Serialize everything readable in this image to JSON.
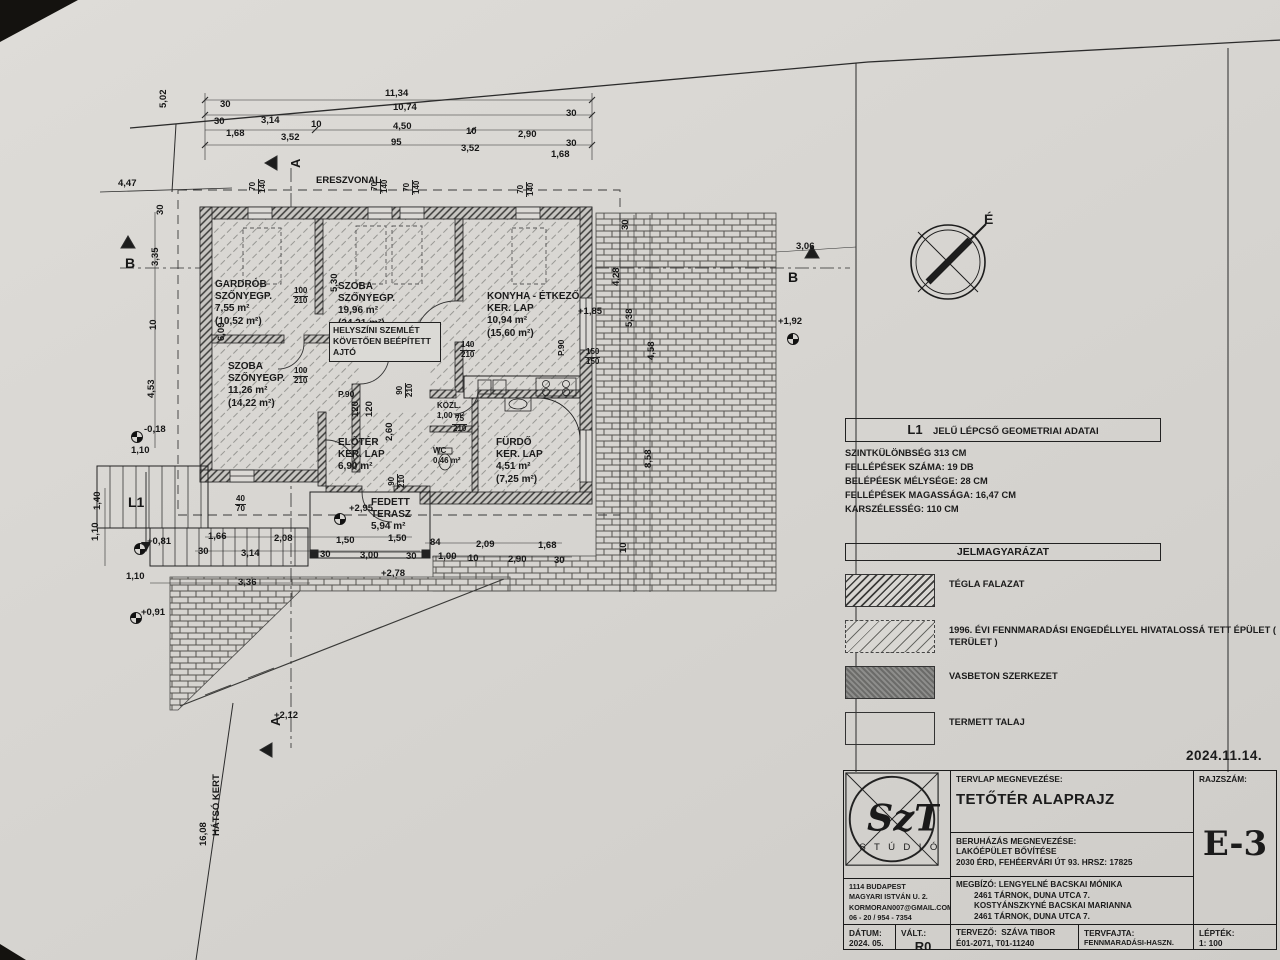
{
  "sheet": {
    "date": "2024.11.14."
  },
  "plan": {
    "north_label": "É",
    "note_box": "HELYSZÍNI SZEMLÉT\nKÖVETŐEN BEÉPÍTETT\nAJTÓ",
    "rooms": [
      {
        "text": "GARDRÓB\nSZŐNYEGP.\n7,55 m²\n(10,52 m²)",
        "x": 215,
        "y": 279
      },
      {
        "text": "SZOBA\nSZŐNYEGP.\n19,96 m²\n(24,21 m²)",
        "x": 338,
        "y": 281
      },
      {
        "text": "KONYHA - ÉTKEZŐ\nKER. LAP\n10,94 m²\n(15,60 m²)",
        "x": 487,
        "y": 291
      },
      {
        "text": "SZOBA\nSZŐNYEGP.\n11,26 m²\n(14,22 m²)",
        "x": 228,
        "y": 361
      },
      {
        "text": "ELŐTÉR\nKER. LAP\n6,90 m²",
        "x": 338,
        "y": 437
      },
      {
        "text": "KÖZL.\n1,00 m²",
        "x": 437,
        "y": 401,
        "fs": 8
      },
      {
        "text": "WC\n0,46 m²",
        "x": 433,
        "y": 446,
        "fs": 8
      },
      {
        "text": "FÜRDŐ\nKER. LAP\n4,51 m²\n(7,25 m²)",
        "x": 496,
        "y": 437
      },
      {
        "text": "FEDETT\nTERASZ\n5,94 m²",
        "x": 371,
        "y": 497
      }
    ],
    "dims": [
      {
        "t": "11,34",
        "x": 385,
        "y": 88
      },
      {
        "t": "30",
        "x": 220,
        "y": 99
      },
      {
        "t": "10,74",
        "x": 393,
        "y": 102
      },
      {
        "t": "30",
        "x": 566,
        "y": 108
      },
      {
        "t": "30",
        "x": 214,
        "y": 116
      },
      {
        "t": "3,14",
        "x": 261,
        "y": 115
      },
      {
        "t": "10",
        "x": 311,
        "y": 119
      },
      {
        "t": "4,50",
        "x": 393,
        "y": 121
      },
      {
        "t": "10",
        "x": 466,
        "y": 126
      },
      {
        "t": "2,90",
        "x": 518,
        "y": 129
      },
      {
        "t": "30",
        "x": 566,
        "y": 138
      },
      {
        "t": "1,68",
        "x": 226,
        "y": 128
      },
      {
        "t": "3,52",
        "x": 281,
        "y": 132
      },
      {
        "t": "95",
        "x": 391,
        "y": 137
      },
      {
        "t": "3,52",
        "x": 461,
        "y": 143
      },
      {
        "t": "1,68",
        "x": 551,
        "y": 149
      },
      {
        "t": "5,02",
        "x": 158,
        "y": 108,
        "r": -90
      },
      {
        "t": "4,47",
        "x": 118,
        "y": 178
      },
      {
        "t": "30",
        "x": 155,
        "y": 215,
        "r": -90
      },
      {
        "t": "3,35",
        "x": 150,
        "y": 266,
        "r": -90
      },
      {
        "t": "10",
        "x": 148,
        "y": 330,
        "r": -90
      },
      {
        "t": "4,53",
        "x": 146,
        "y": 398,
        "r": -90
      },
      {
        "t": "6,09",
        "x": 216,
        "y": 341,
        "r": -90
      },
      {
        "t": "5,30",
        "x": 329,
        "y": 292,
        "r": -90
      },
      {
        "t": "2,60",
        "x": 384,
        "y": 441,
        "r": -90
      },
      {
        "t": "120",
        "x": 350,
        "y": 417,
        "r": -90
      },
      {
        "t": "120",
        "x": 364,
        "y": 417,
        "r": -90
      },
      {
        "t": "1,10",
        "x": 131,
        "y": 445
      },
      {
        "t": "1,40",
        "x": 92,
        "y": 510,
        "r": -90
      },
      {
        "t": "1,10",
        "x": 90,
        "y": 541,
        "r": -90
      },
      {
        "t": "1,10",
        "x": 126,
        "y": 571
      },
      {
        "t": "3,36",
        "x": 238,
        "y": 577
      },
      {
        "t": "16,08",
        "x": 198,
        "y": 846,
        "r": -90
      },
      {
        "t": "3,06",
        "x": 796,
        "y": 241
      },
      {
        "t": "30",
        "x": 620,
        "y": 230,
        "r": -90
      },
      {
        "t": "4,28",
        "x": 611,
        "y": 286,
        "r": -90
      },
      {
        "t": "5,38",
        "x": 624,
        "y": 327,
        "r": -90
      },
      {
        "t": "4,58",
        "x": 646,
        "y": 360,
        "r": -90
      },
      {
        "t": "8,58",
        "x": 643,
        "y": 468,
        "r": -90
      },
      {
        "t": "10",
        "x": 618,
        "y": 553,
        "r": -90
      },
      {
        "t": "1,66",
        "x": 208,
        "y": 531
      },
      {
        "t": "2,08",
        "x": 274,
        "y": 533
      },
      {
        "t": "1,50",
        "x": 336,
        "y": 535
      },
      {
        "t": "1,50",
        "x": 388,
        "y": 533
      },
      {
        "t": "30",
        "x": 198,
        "y": 546
      },
      {
        "t": "3,14",
        "x": 241,
        "y": 548
      },
      {
        "t": "30",
        "x": 320,
        "y": 549
      },
      {
        "t": "3,00",
        "x": 360,
        "y": 550
      },
      {
        "t": "30",
        "x": 406,
        "y": 551
      },
      {
        "t": "84",
        "x": 430,
        "y": 537
      },
      {
        "t": "2,09",
        "x": 476,
        "y": 539
      },
      {
        "t": "1,68",
        "x": 538,
        "y": 540
      },
      {
        "t": "1,00",
        "x": 438,
        "y": 551
      },
      {
        "t": "10",
        "x": 468,
        "y": 553
      },
      {
        "t": "2,90",
        "x": 508,
        "y": 554
      },
      {
        "t": "30",
        "x": 554,
        "y": 555
      }
    ],
    "levels": [
      {
        "t": "-0,18",
        "x": 144,
        "y": 424
      },
      {
        "t": "+0,81",
        "x": 147,
        "y": 536
      },
      {
        "t": "+0,91",
        "x": 141,
        "y": 607
      },
      {
        "t": "+2,95",
        "x": 349,
        "y": 503
      },
      {
        "t": "+2,78",
        "x": 381,
        "y": 568
      },
      {
        "t": "+2,12",
        "x": 274,
        "y": 710
      },
      {
        "t": "+1,85",
        "x": 578,
        "y": 306
      },
      {
        "t": "+1,92",
        "x": 778,
        "y": 316
      }
    ],
    "openings": [
      {
        "top": "100",
        "bot": "210",
        "x": 293,
        "y": 287
      },
      {
        "top": "100",
        "bot": "210",
        "x": 293,
        "y": 367
      },
      {
        "top": "140",
        "bot": "210",
        "x": 460,
        "y": 341
      },
      {
        "top": "75",
        "bot": "210",
        "x": 452,
        "y": 415
      },
      {
        "top": "90",
        "bot": "210",
        "x": 396,
        "y": 398,
        "r": -90
      },
      {
        "top": "90",
        "bot": "210",
        "x": 388,
        "y": 489,
        "r": -90
      },
      {
        "top": "150",
        "bot": "150",
        "x": 585,
        "y": 348
      },
      {
        "top": "40",
        "bot": "70",
        "x": 235,
        "y": 495
      },
      {
        "top": "70",
        "bot": "140",
        "x": 249,
        "y": 194,
        "r": -90
      },
      {
        "top": "70",
        "bot": "140",
        "x": 371,
        "y": 194,
        "r": -90
      },
      {
        "top": "70",
        "bot": "140",
        "x": 403,
        "y": 195,
        "r": -90
      },
      {
        "top": "70",
        "bot": "140",
        "x": 517,
        "y": 197,
        "r": -90
      }
    ],
    "misc": [
      {
        "t": "ERESZVONAL",
        "x": 316,
        "y": 175,
        "fs": 9.5
      },
      {
        "t": "HÁTSÓ KERT",
        "x": 211,
        "y": 836,
        "r": -90,
        "fs": 9.5
      },
      {
        "t": "L1",
        "x": 128,
        "y": 494,
        "fs": 14
      },
      {
        "t": "P.90",
        "x": 338,
        "y": 389,
        "fs": 8.5
      },
      {
        "t": "P.90",
        "x": 556,
        "y": 356,
        "r": -90,
        "fs": 8.5
      },
      {
        "t": "B",
        "x": 125,
        "y": 255,
        "fs": 14
      },
      {
        "t": "B",
        "x": 788,
        "y": 269,
        "fs": 14
      },
      {
        "t": "A",
        "x": 288,
        "y": 168,
        "r": -90,
        "fs": 13
      },
      {
        "t": "A",
        "x": 268,
        "y": 726,
        "r": -90,
        "fs": 13
      }
    ]
  },
  "stair_table": {
    "code": "L1",
    "title": "JELŰ LÉPCSŐ GEOMETRIAI ADATAI",
    "rows": [
      "SZINTKÜLÖNBSÉG 313 CM",
      "FELLÉPÉSEK SZÁMA: 19 DB",
      "BELÉPÉESK MÉLYSÉGE: 28 CM",
      "FELLÉPÉSEK MAGASSÁGA: 16,47 CM",
      "KARSZÉLESSÉG: 110 CM"
    ]
  },
  "legend": {
    "title": "JELMAGYARÁZAT",
    "items": [
      {
        "label": "TÉGLA FALAZAT",
        "pattern": "brick-wall-hatch"
      },
      {
        "label": "1996. ÉVI FENNMARADÁSI ENGEDÉLLYEL HIVATALOSSÁ TETT ÉPÜLET ( TERÜLET )",
        "pattern": "dashed-hatch"
      },
      {
        "label": "VASBETON SZERKEZET",
        "pattern": "concrete-hatch"
      },
      {
        "label": "TERMETT TALAJ",
        "pattern": "soil-hatch"
      }
    ]
  },
  "title_block": {
    "logo": {
      "main": "SzT",
      "sub": "S T Ú D I Ó"
    },
    "sheet_name_label": "TERVLAP MEGNEVEZÉSE:",
    "sheet_name": "TETŐTÉR ALAPRAJZ",
    "project_label": "BERUHÁZÁS MEGNEVEZÉSE:",
    "project_name": "LAKÓÉPÜLET BŐVÍTÉSE",
    "project_address": "2030 ÉRD, FEHÉERVÁRI ÚT 93.  HRSZ: 17825",
    "client": "MEGBÍZÓ: LENGYELNÉ BACSKAI MÓNIKA\n        2461 TÁRNOK, DUNA UTCA 7.\n        KOSTYÁNSZKYNÉ BACSKAI MARIANNA\n        2461 TÁRNOK, DUNA UTCA 7.",
    "office_address": "1114 BUDAPEST\nMAGYARI ISTVÁN U. 2.\nKORMORAN007@GMAIL.COM\n06 - 20 / 954 - 7354",
    "date_label": "DÁTUM:",
    "date": "2024. 05.",
    "rev_label": "VÁLT.:",
    "rev": "R0",
    "designer": "TERVEZŐ:  SZÁVA TIBOR\nÉ01-2071, T01-11240",
    "plan_type_label": "TERVFAJTA:",
    "plan_type": "FENNMARADÁSI-HASZN.",
    "scale_label": "LÉPTÉK:",
    "scale": "1: 100",
    "drawing_no_label": "RAJZSZÁM:",
    "drawing_no": "E-3"
  }
}
